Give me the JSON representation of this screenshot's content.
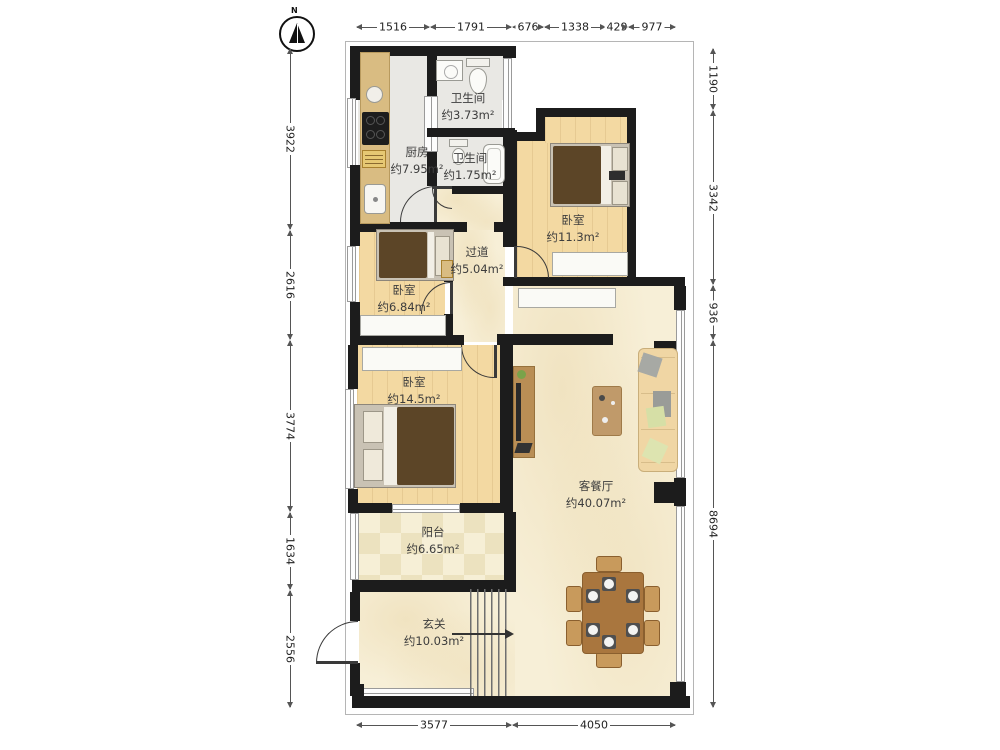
{
  "compass": {
    "label": "N"
  },
  "rooms": {
    "bath_main": {
      "name": "卫生间",
      "area": "约3.73m²"
    },
    "kitchen": {
      "name": "厨房",
      "area": "约7.95m²"
    },
    "bath_small": {
      "name": "卫生间",
      "area": "约1.75m²"
    },
    "bedroom_right": {
      "name": "卧室",
      "area": "约11.3m²"
    },
    "hallway": {
      "name": "过道",
      "area": "约5.04m²"
    },
    "bedroom_mid": {
      "name": "卧室",
      "area": "约6.84m²"
    },
    "bedroom_large": {
      "name": "卧室",
      "area": "约14.5m²"
    },
    "living": {
      "name": "客餐厅",
      "area": "约40.07m²"
    },
    "balcony": {
      "name": "阳台",
      "area": "约6.65m²"
    },
    "entry": {
      "name": "玄关",
      "area": "约10.03m²"
    }
  },
  "dims": {
    "top": [
      "1516",
      "1791",
      "676",
      "1338",
      "429",
      "977"
    ],
    "left": [
      "3922",
      "2616",
      "3774",
      "1634",
      "2556"
    ],
    "right": [
      "1190",
      "3342",
      "936",
      "8694"
    ],
    "bottom": [
      "3577",
      "4050"
    ]
  },
  "colors": {
    "wall": "#1c1c1c",
    "wood_floor": "#f3d9a2",
    "marble_floor": "#f7efd7",
    "tile_floor": "#e9e8e4",
    "counter": "#d9bc82",
    "bed": "#5c4527",
    "sofa": "#f0d6a4",
    "dining_table": "#a9763e"
  }
}
